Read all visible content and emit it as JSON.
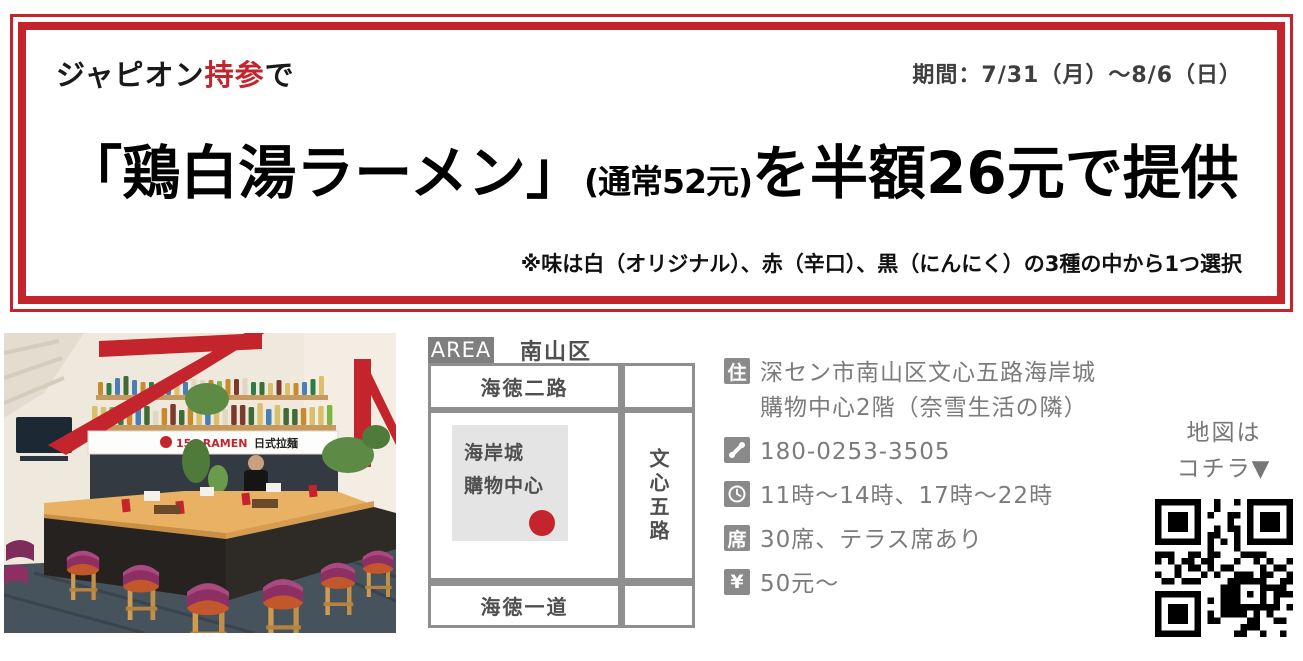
{
  "coupon": {
    "tagline_prefix": "ジャピオン",
    "tagline_highlight": "持参",
    "tagline_suffix": "で",
    "period": "期間：7/31（月）〜8/6（日）",
    "headline_open": "「鶏白湯ラーメン」",
    "headline_price_note": "(通常52元)",
    "headline_rest": "を半額26元で提供",
    "flavor_note": "※味は白（オリジナル）、赤（辛口）、黒（にんにく）の3種の中から1つ選択"
  },
  "map": {
    "area_label": "AREA",
    "area_name": "南山区",
    "street_top": "海徳二路",
    "street_right": "文心五路",
    "street_bottom": "海徳一道",
    "building_line1": "海岸城",
    "building_line2": "購物中心"
  },
  "info": {
    "address_icon": "住",
    "address_line1": "深セン市南山区文心五路海岸城",
    "address_line2": "購物中心2階（奈雪生活の隣）",
    "phone_icon": "phone-receiver-icon",
    "phone": "180-0253-3505",
    "clock_icon": "clock-icon",
    "hours": "11時〜14時、17時〜22時",
    "seats_icon": "席",
    "seats": "30席、テラス席あり",
    "price_icon": "¥",
    "price": "50元〜"
  },
  "qr": {
    "label_line1": "地図は",
    "label_line2": "コチラ▼"
  },
  "photo": {
    "banner_text_1": "156 RAMEN",
    "banner_text_2": "日式拉麺"
  },
  "colors": {
    "accent_red": "#c4242c",
    "road_gray": "#8f8f8f",
    "info_gray": "#7b7b7b"
  }
}
